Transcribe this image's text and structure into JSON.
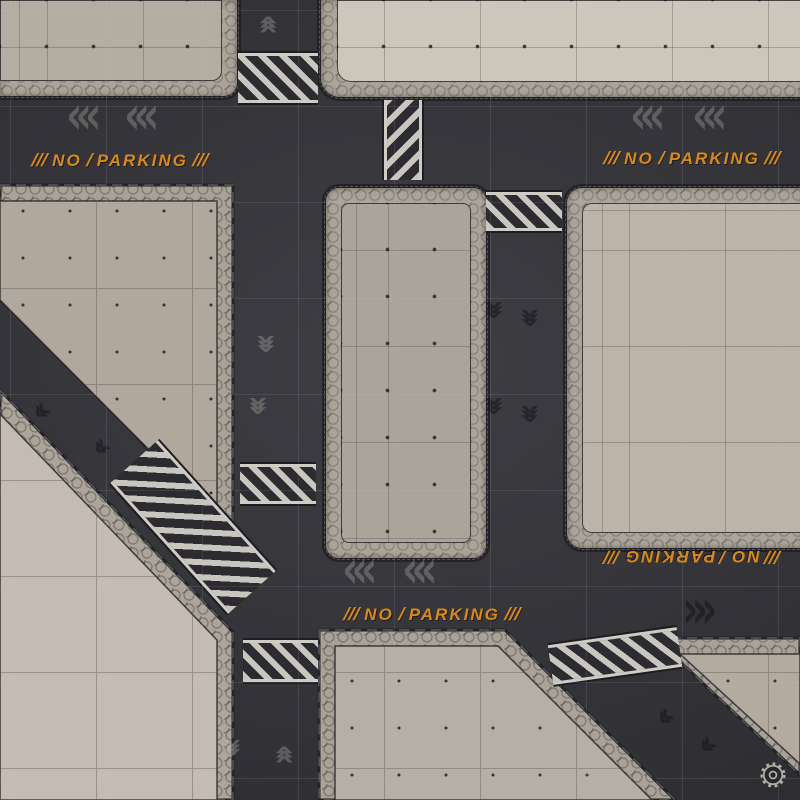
{
  "page": {
    "title": "Sci-fi urban gaming mat — top-down roads and concrete pads"
  },
  "mat": {
    "description": "Dark asphalt roads in a grid with diagonal avenues, light concrete landing pads with hex-plate sidewalk borders, hazard-striped crossings and painted road chevrons",
    "grid_spacing_px": 96,
    "colors": {
      "road_asphalt": "#36363c",
      "grid_line": "#c3c3cd",
      "pad_concrete": "#b5aea4",
      "pad_concrete_bright": "#cdc6bb",
      "sidewalk_band": "#aaa49a",
      "edge_outline": "#232327",
      "crosswalk_light": "#c9c6c0",
      "crosswalk_dark": "#2b2b30",
      "marking_orange": "#d8891d",
      "chevron_light": "#c8c4ba",
      "chevron_dark": "#141417"
    }
  },
  "markings": {
    "no_parking_label": "NO PARKING",
    "word1": "NO",
    "separator": "/",
    "word2": "PARKING",
    "slashes": "///",
    "instances": [
      {
        "location": "west main road, upper",
        "rotation_deg": 0
      },
      {
        "location": "east main road, upper",
        "rotation_deg": 0
      },
      {
        "location": "center south road",
        "rotation_deg": 0
      },
      {
        "location": "east south road",
        "rotation_deg": 180
      }
    ]
  },
  "icons": {
    "chevron_triple_left": "‹‹‹",
    "chevron_triple_right": "›››",
    "chevron_double_left": "‹‹",
    "logo": "gear-icon"
  }
}
